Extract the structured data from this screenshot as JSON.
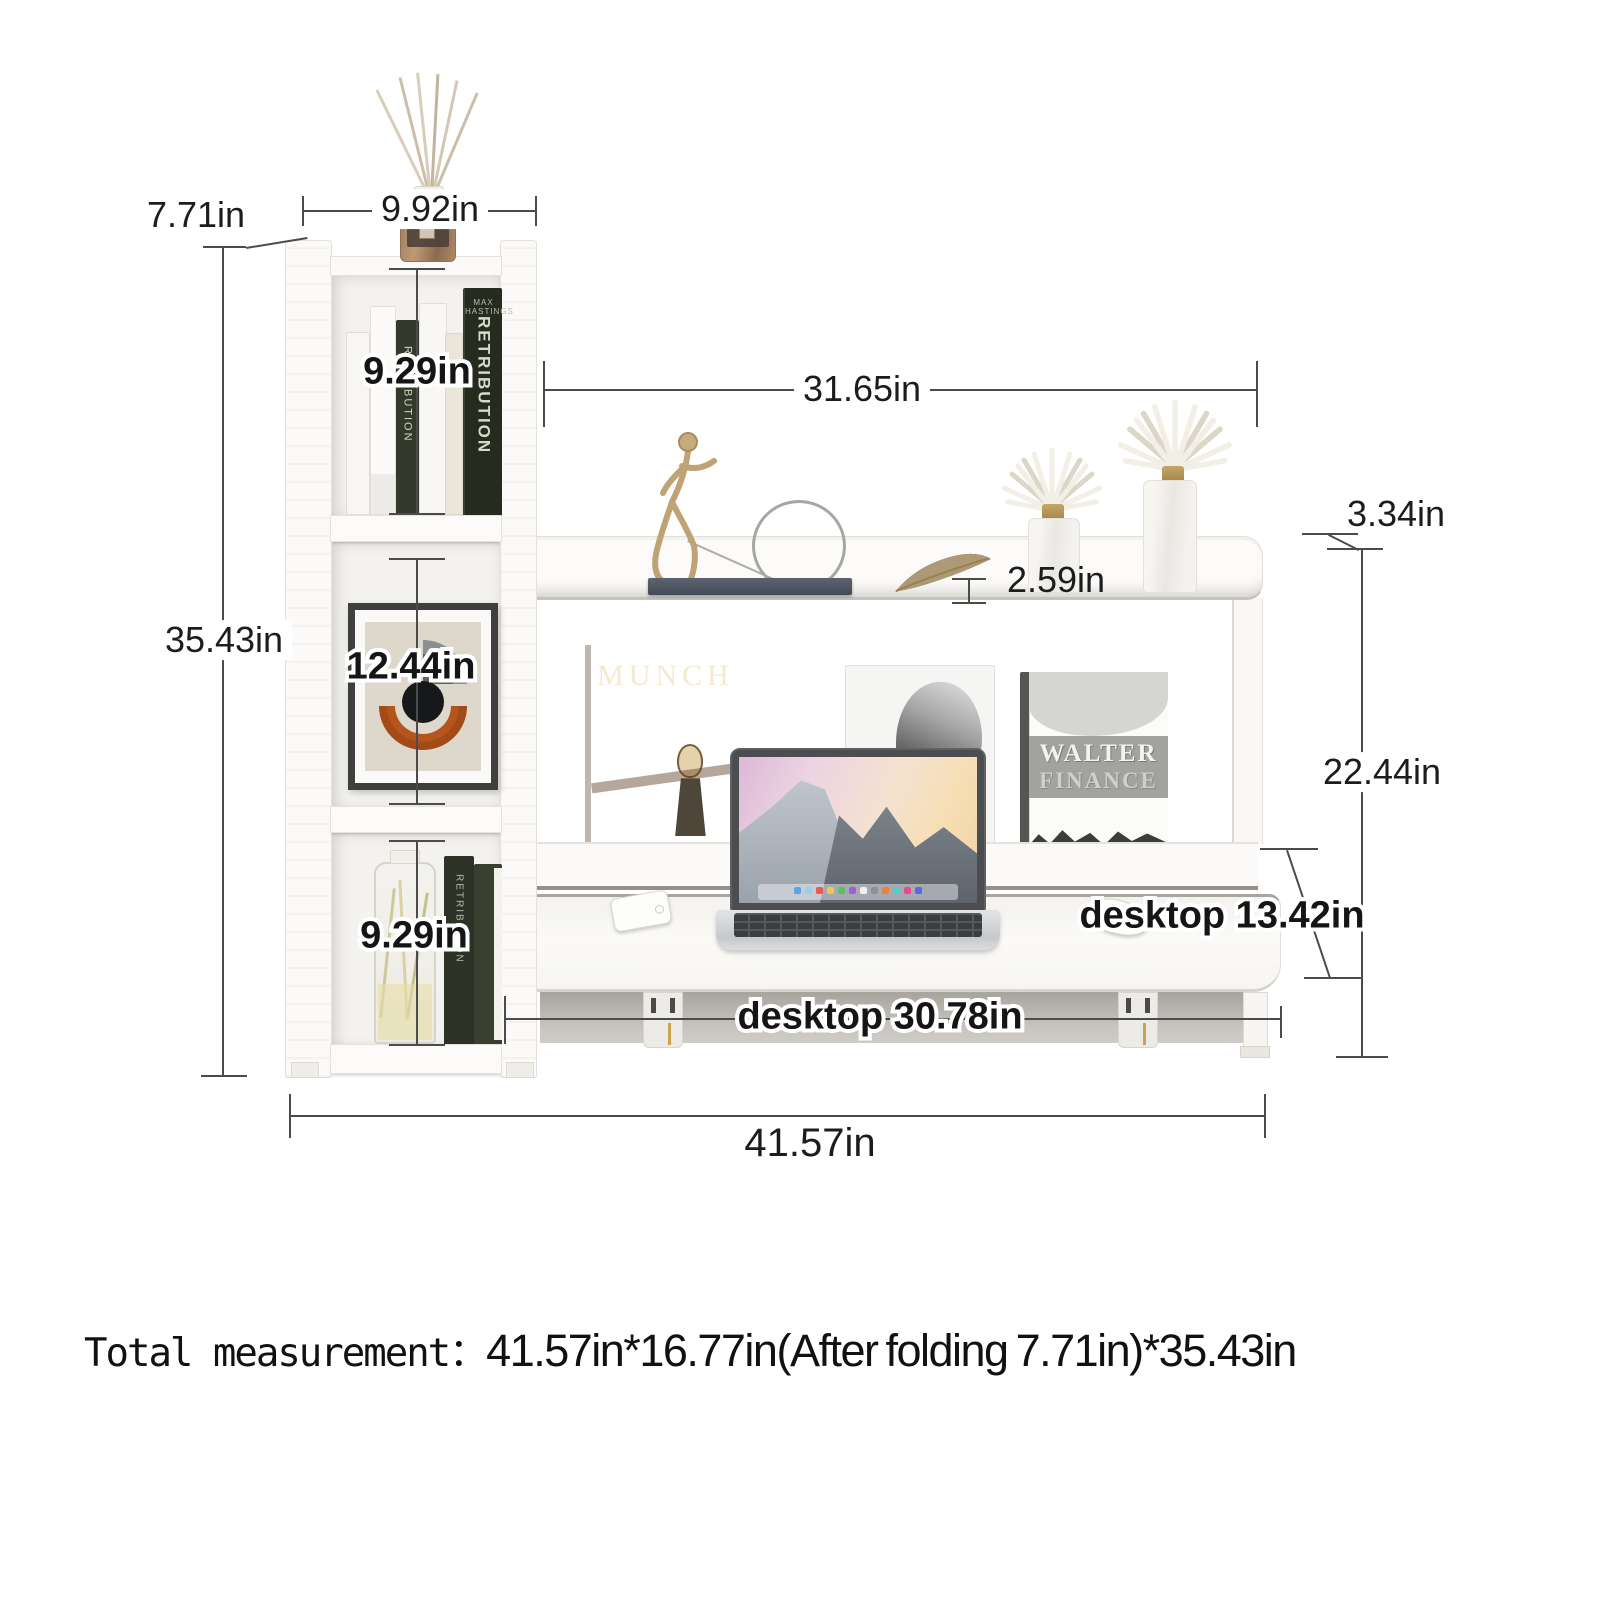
{
  "dimensions": {
    "fold_depth": "7.71in",
    "top_width": "9.92in",
    "shelf1_height": "9.29in",
    "shelf2_height": "12.44in",
    "shelf3_height": "9.29in",
    "total_height": "35.43in",
    "upper_shelf_width": "31.65in",
    "lip_height": "2.59in",
    "shelf_edge": "3.34in",
    "shelf_to_desk": "22.44in",
    "desk_depth": "desktop 13.42in",
    "desk_width": "desktop 30.78in",
    "total_width": "41.57in"
  },
  "decor": {
    "munch_title": "MUNCH",
    "walter_line1": "WALTER",
    "walter_line2": "FINANCE",
    "spine_title": "RETRIBUTION",
    "spine_author": "MAX HASTINGS"
  },
  "footer": {
    "label": "Total measurement：",
    "value": "41.57in*16.77in(After folding 7.71in)*35.43in"
  },
  "colors": {
    "dimension_line": "#4b4b4b",
    "furniture_white": "#fbfaf8",
    "gold_accent": "#c2a678",
    "munch_orange": "#e0832f",
    "art_orange": "#b5541b",
    "dark_book_green": "#2c3226"
  }
}
